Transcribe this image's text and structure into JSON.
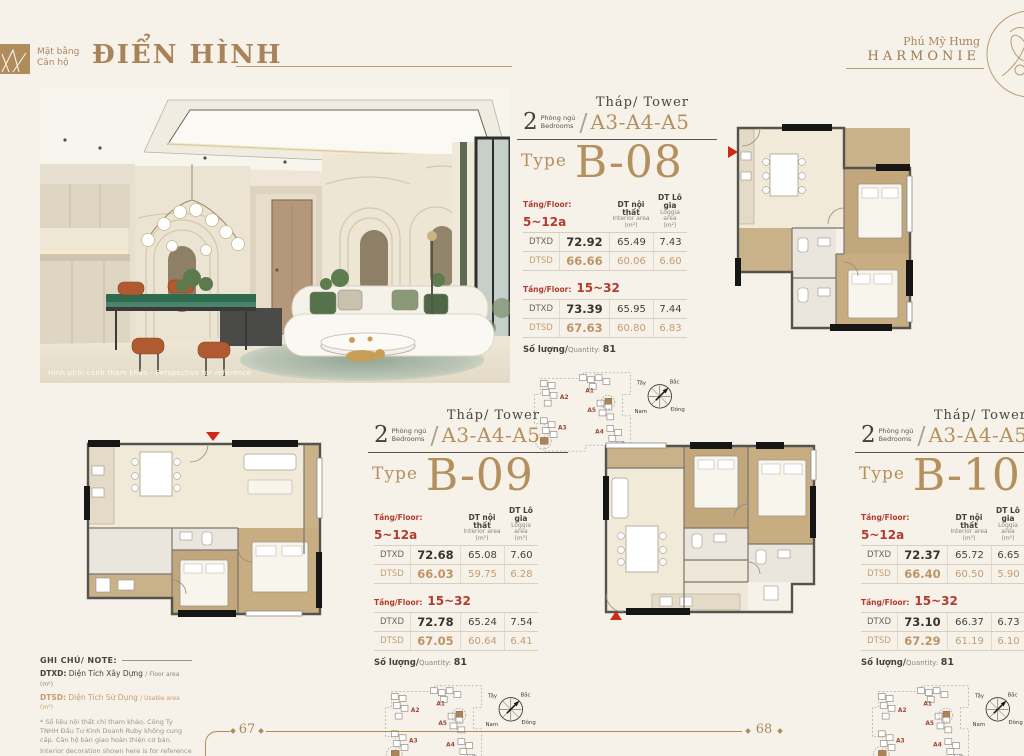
{
  "labels": {
    "slash": "/"
  },
  "header": {
    "title_small1": "Mặt bằng",
    "title_small2": "Căn hộ",
    "title_large": "ĐIỂN HÌNH"
  },
  "brand": {
    "line1": "Phú Mỹ Hưng",
    "line2": "HARMONIE"
  },
  "photo": {
    "caption": "Hình phối cảnh tham khảo - Perspective for reference"
  },
  "units": [
    {
      "bedrooms_count": "2",
      "bedrooms_vi": "Phòng ngủ",
      "bedrooms_en": "Bedrooms",
      "tower_label": "Tháp/ Tower",
      "tower_codes": "A3-A4-A5",
      "type_label": "Type",
      "type_code": "B-08",
      "col_interior_title": "DT nội thất",
      "col_interior_sub": "Interior area",
      "col_interior_unit": "(m²)",
      "col_loggia_title": "DT Lô gia",
      "col_loggia_sub": "Loggia area",
      "col_loggia_unit": "(m²)",
      "sections": [
        {
          "floor_label": "Tầng/Floor:",
          "floor_range": "5~12a",
          "rows": [
            {
              "label": "DTXD",
              "total": "72.92",
              "interior": "65.49",
              "loggia": "7.43"
            },
            {
              "label": "DTSD",
              "total": "66.66",
              "interior": "60.06",
              "loggia": "6.60"
            }
          ]
        },
        {
          "floor_label": "Tầng/Floor:",
          "floor_range": "15~32",
          "rows": [
            {
              "label": "DTXD",
              "total": "73.39",
              "interior": "65.95",
              "loggia": "7.44"
            },
            {
              "label": "DTSD",
              "total": "67.63",
              "interior": "60.80",
              "loggia": "6.83"
            }
          ]
        }
      ],
      "qty_label": "Số lượng/",
      "qty_en": "Quantity:",
      "qty_value": "81"
    },
    {
      "bedrooms_count": "2",
      "bedrooms_vi": "Phòng ngủ",
      "bedrooms_en": "Bedrooms",
      "tower_label": "Tháp/ Tower",
      "tower_codes": "A3-A4-A5",
      "type_label": "Type",
      "type_code": "B-09",
      "col_interior_title": "DT nội thất",
      "col_interior_sub": "Interior area",
      "col_interior_unit": "(m²)",
      "col_loggia_title": "DT Lô gia",
      "col_loggia_sub": "Loggia area",
      "col_loggia_unit": "(m²)",
      "sections": [
        {
          "floor_label": "Tầng/Floor:",
          "floor_range": "5~12a",
          "rows": [
            {
              "label": "DTXD",
              "total": "72.68",
              "interior": "65.08",
              "loggia": "7.60"
            },
            {
              "label": "DTSD",
              "total": "66.03",
              "interior": "59.75",
              "loggia": "6.28"
            }
          ]
        },
        {
          "floor_label": "Tầng/Floor:",
          "floor_range": "15~32",
          "rows": [
            {
              "label": "DTXD",
              "total": "72.78",
              "interior": "65.24",
              "loggia": "7.54"
            },
            {
              "label": "DTSD",
              "total": "67.05",
              "interior": "60.64",
              "loggia": "6.41"
            }
          ]
        }
      ],
      "qty_label": "Số lượng/",
      "qty_en": "Quantity:",
      "qty_value": "81"
    },
    {
      "bedrooms_count": "2",
      "bedrooms_vi": "Phòng ngủ",
      "bedrooms_en": "Bedrooms",
      "tower_label": "Tháp/ Tower",
      "tower_codes": "A3-A4-A5",
      "type_label": "Type",
      "type_code": "B-10",
      "col_interior_title": "DT nội thất",
      "col_interior_sub": "Interior area",
      "col_interior_unit": "(m²)",
      "col_loggia_title": "DT Lô gia",
      "col_loggia_sub": "Loggia area",
      "col_loggia_unit": "(m²)",
      "sections": [
        {
          "floor_label": "Tầng/Floor:",
          "floor_range": "5~12a",
          "rows": [
            {
              "label": "DTXD",
              "total": "72.37",
              "interior": "65.72",
              "loggia": "6.65"
            },
            {
              "label": "DTSD",
              "total": "66.40",
              "interior": "60.50",
              "loggia": "5.90"
            }
          ]
        },
        {
          "floor_label": "Tầng/Floor:",
          "floor_range": "15~32",
          "rows": [
            {
              "label": "DTXD",
              "total": "73.10",
              "interior": "66.37",
              "loggia": "6.73"
            },
            {
              "label": "DTSD",
              "total": "67.29",
              "interior": "61.19",
              "loggia": "6.10"
            }
          ]
        }
      ],
      "qty_label": "Số lượng/",
      "qty_en": "Quantity:",
      "qty_value": "81"
    }
  ],
  "keyplan": {
    "t_a1": "A1",
    "t_a2": "A2",
    "t_a3": "A3",
    "t_a4": "A4",
    "t_a5": "A5",
    "compass_n": "Bắc",
    "compass_s": "Nam",
    "compass_e": "Đông",
    "compass_w": "Tây"
  },
  "notes": {
    "title": "GHI CHÚ/ NOTE:",
    "dtxd_term": "DTXD:",
    "dtxd_vi": "Diện Tích Xây Dựng",
    "dtxd_en": "/ Floor area (m²)",
    "dtsd_term": "DTSD:",
    "dtsd_vi": "Diện Tích Sử Dụng",
    "dtsd_en": "/ Usable area (m²)",
    "fine_vi": "* Số liệu nội thất chỉ tham khảo, Công Ty TNHH Đầu Tư Kinh Doanh Ruby không cung cấp. Căn hộ bàn giao hoàn thiện cơ bản.",
    "fine_en": "Interior decoration shown here is for reference and is not supplied by Ruby Investment Business Company Limited. The apartments are standard - style handover."
  },
  "footer": {
    "page_left": "67",
    "page_right": "68"
  }
}
